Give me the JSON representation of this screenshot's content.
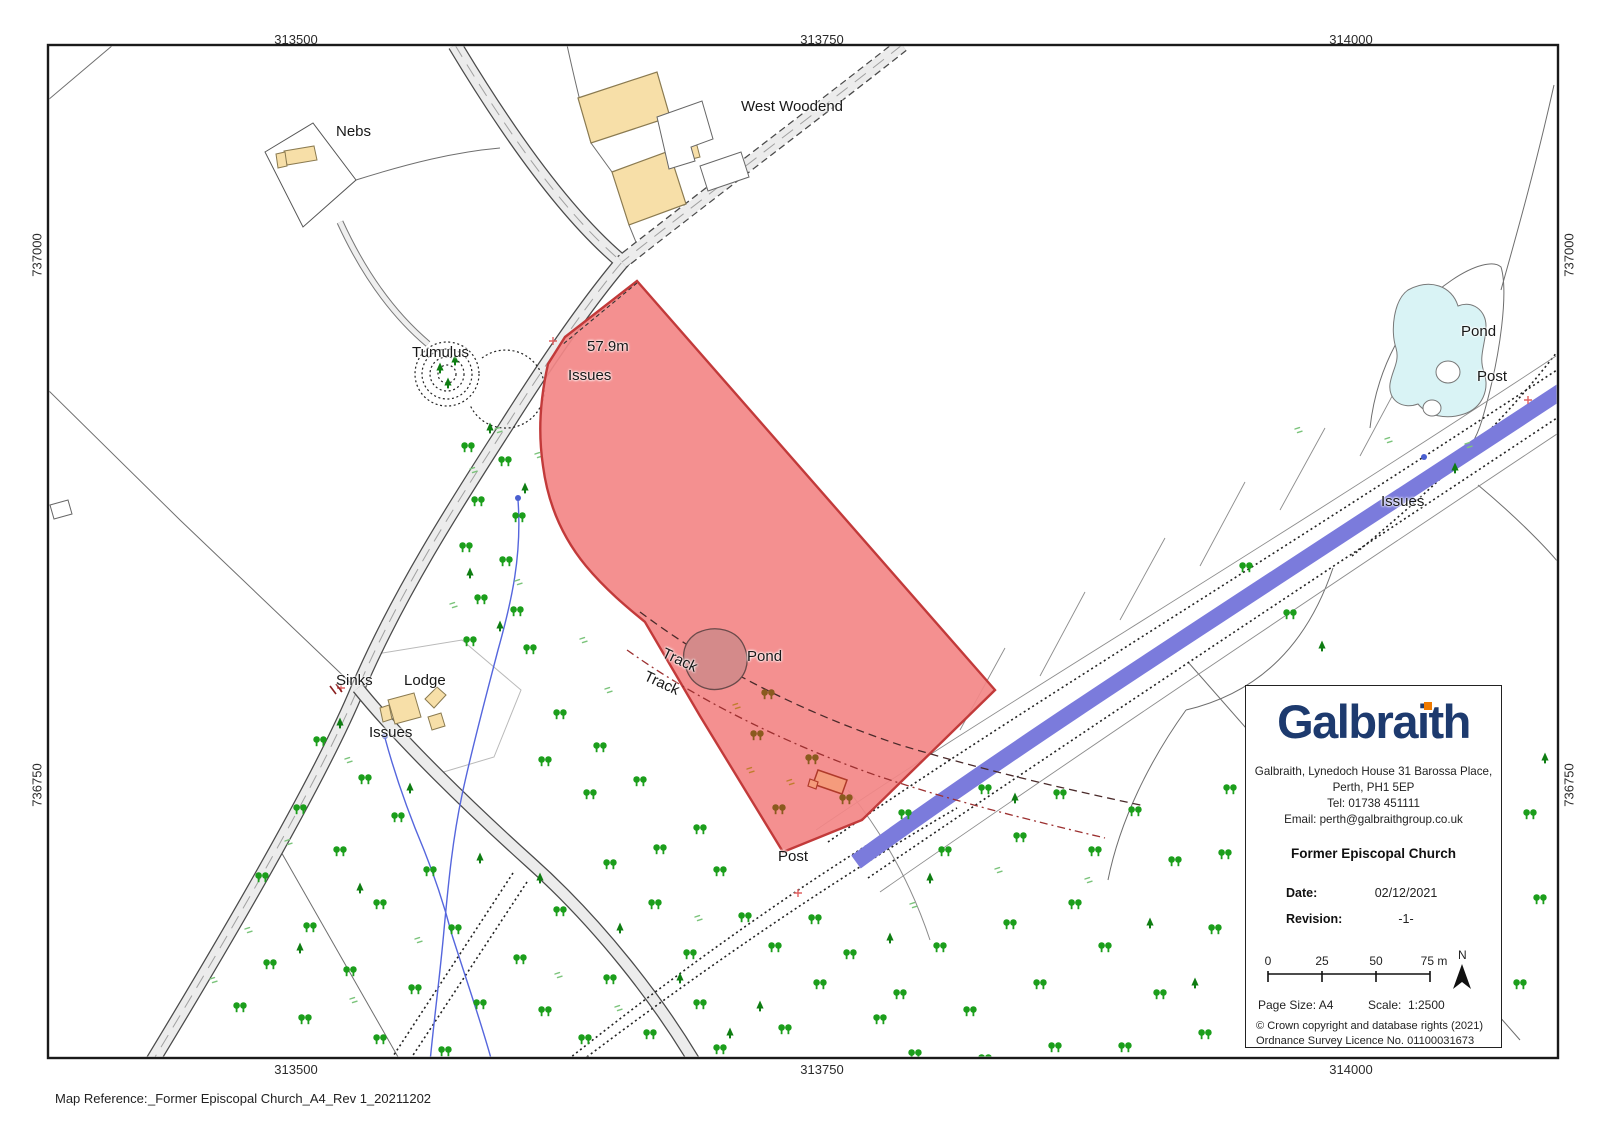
{
  "map": {
    "grid": {
      "e1": "313500",
      "e2": "313750",
      "e3": "314000",
      "n1": "737000",
      "n2": "736750"
    },
    "labels": {
      "nebs": "Nebs",
      "west_woodend": "West Woodend",
      "tumulus": "Tumulus",
      "spot_height": "57.9m",
      "issues_a": "Issues",
      "sinks": "Sinks",
      "lodge": "Lodge",
      "issues_b": "Issues",
      "track_a": "Track",
      "track_b": "Track",
      "pond_a": "Pond",
      "post_a": "Post",
      "pond_b": "Pond",
      "post_b": "Post",
      "issues_c": "Issues"
    }
  },
  "info_box": {
    "brand": "Galbraith",
    "address_line1": "Galbraith, Lynedoch House 31 Barossa Place,",
    "address_line2": "Perth, PH1 5EP",
    "address_line3": "Tel: 01738 451111",
    "address_line4": "Email: perth@galbraithgroup.co.uk",
    "title": "Former Episcopal Church",
    "date_label": "Date:",
    "date_value": "02/12/2021",
    "revision_label": "Revision:",
    "revision_value": "-1-",
    "scale_ticks": [
      "0",
      "25",
      "50",
      "75 m"
    ],
    "north": "N",
    "page_size": "Page Size: A4",
    "scale_label": "Scale:",
    "scale_value": "1:2500",
    "copyright1": "© Crown copyright and database rights (2021)",
    "copyright2": "Ordnance Survey Licence No. 01100031673"
  },
  "footer": {
    "map_ref_label": "Map Reference:",
    "map_ref_value": "_Former Episcopal Church_A4_Rev 1_20211202"
  },
  "colors": {
    "highlight_fill": "#F38787",
    "highlight_stroke": "#C23A3A",
    "water_channel": "#7B7BDC",
    "pond_cyan": "#D9F3F5",
    "building_tan": "#F7DFA8",
    "road_grey": "#ECECEC",
    "tree_green": "#1B9E1B",
    "brand_navy": "#1D3A6E",
    "brand_orange": "#EF7A00"
  }
}
